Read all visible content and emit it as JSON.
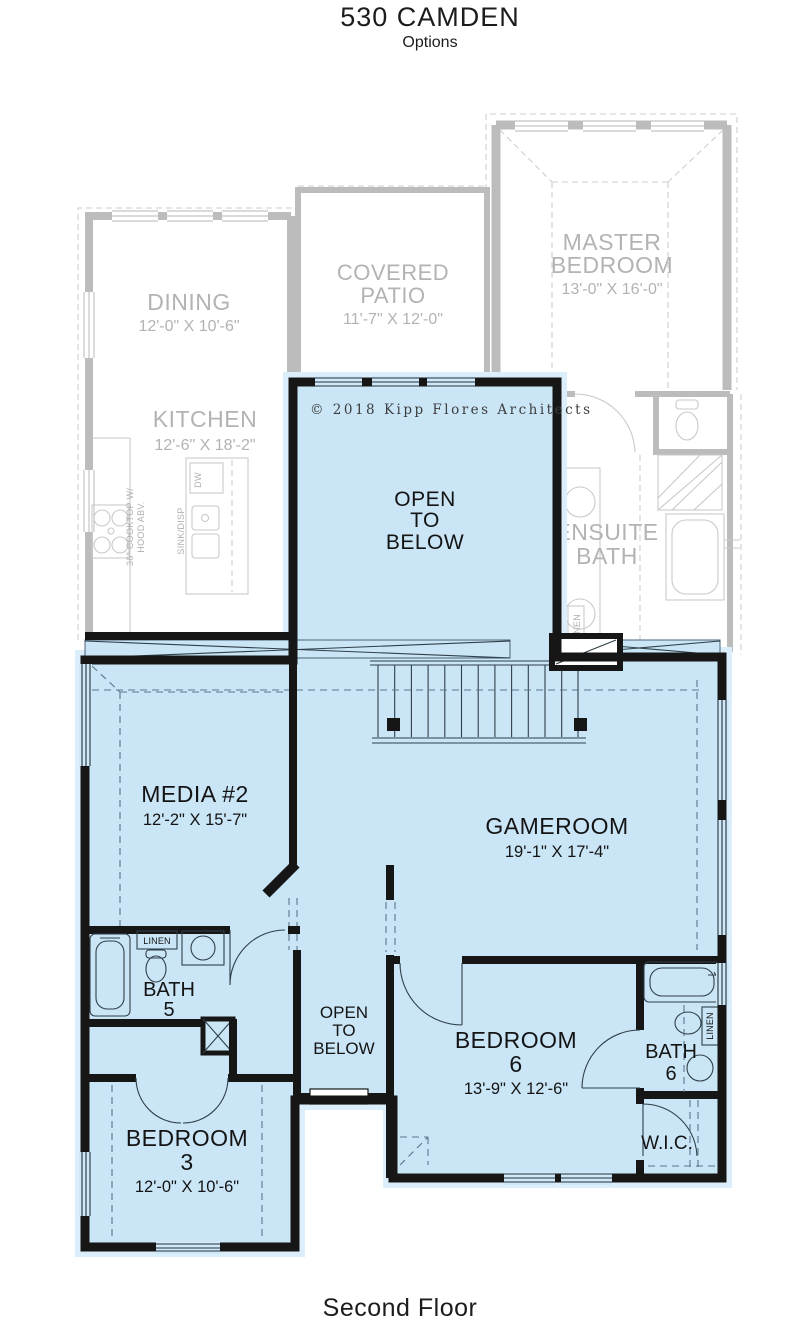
{
  "header": {
    "title": "530 CAMDEN",
    "subtitle": "Options"
  },
  "footer": {
    "label": "Second Floor"
  },
  "plan": {
    "copyright": "© 2018 Kipp Flores Architects",
    "first_floor": {
      "dining": {
        "name": "DINING",
        "dims": "12'-0\" X 10'-6\""
      },
      "kitchen": {
        "name": "KITCHEN",
        "dims": "12'-6\" X 18'-2\"",
        "cooktop_line1": "36\" COOKTOP W/",
        "cooktop_line2": "HOOD ABV.",
        "dw": "DW",
        "sink": "SINK/DISP"
      },
      "covered_patio": {
        "line1": "COVERED",
        "line2": "PATIO",
        "dims": "11'-7\" X 12'-0\""
      },
      "master_bedroom": {
        "line1": "MASTER",
        "line2": "BEDROOM",
        "dims": "13'-0\" X 16'-0\""
      },
      "ensuite_bath": {
        "line1": "ENSUITE",
        "line2": "BATH",
        "linen": "LINEN"
      }
    },
    "second_floor": {
      "open_to_below": {
        "line1": "OPEN",
        "line2": "TO",
        "line3": "BELOW"
      },
      "media2": {
        "name": "MEDIA #2",
        "dims": "12'-2\" X 15'-7\""
      },
      "gameroom": {
        "name": "GAMEROOM",
        "dims": "19'-1\" X 17'-4\""
      },
      "bath5": {
        "line1": "BATH",
        "line2": "5",
        "linen": "LINEN"
      },
      "bedroom6": {
        "line1": "BEDROOM",
        "line2": "6",
        "dims": "13'-9\" X 12'-6\""
      },
      "bath6": {
        "line1": "BATH",
        "line2": "6",
        "linen": "LINEN"
      },
      "wic": {
        "name": "W.I.C."
      },
      "bedroom3": {
        "line1": "BEDROOM",
        "line2": "3",
        "dims": "12'-0\" X 10'-6\""
      }
    },
    "colors": {
      "second_floor_fill": "#c9e5f6",
      "second_floor_glow": "#dbeefb",
      "wall_black": "#161616",
      "first_floor_gray": "#bcbcbc",
      "label_gray": "#b3b3b3",
      "label_black": "#141414"
    }
  }
}
